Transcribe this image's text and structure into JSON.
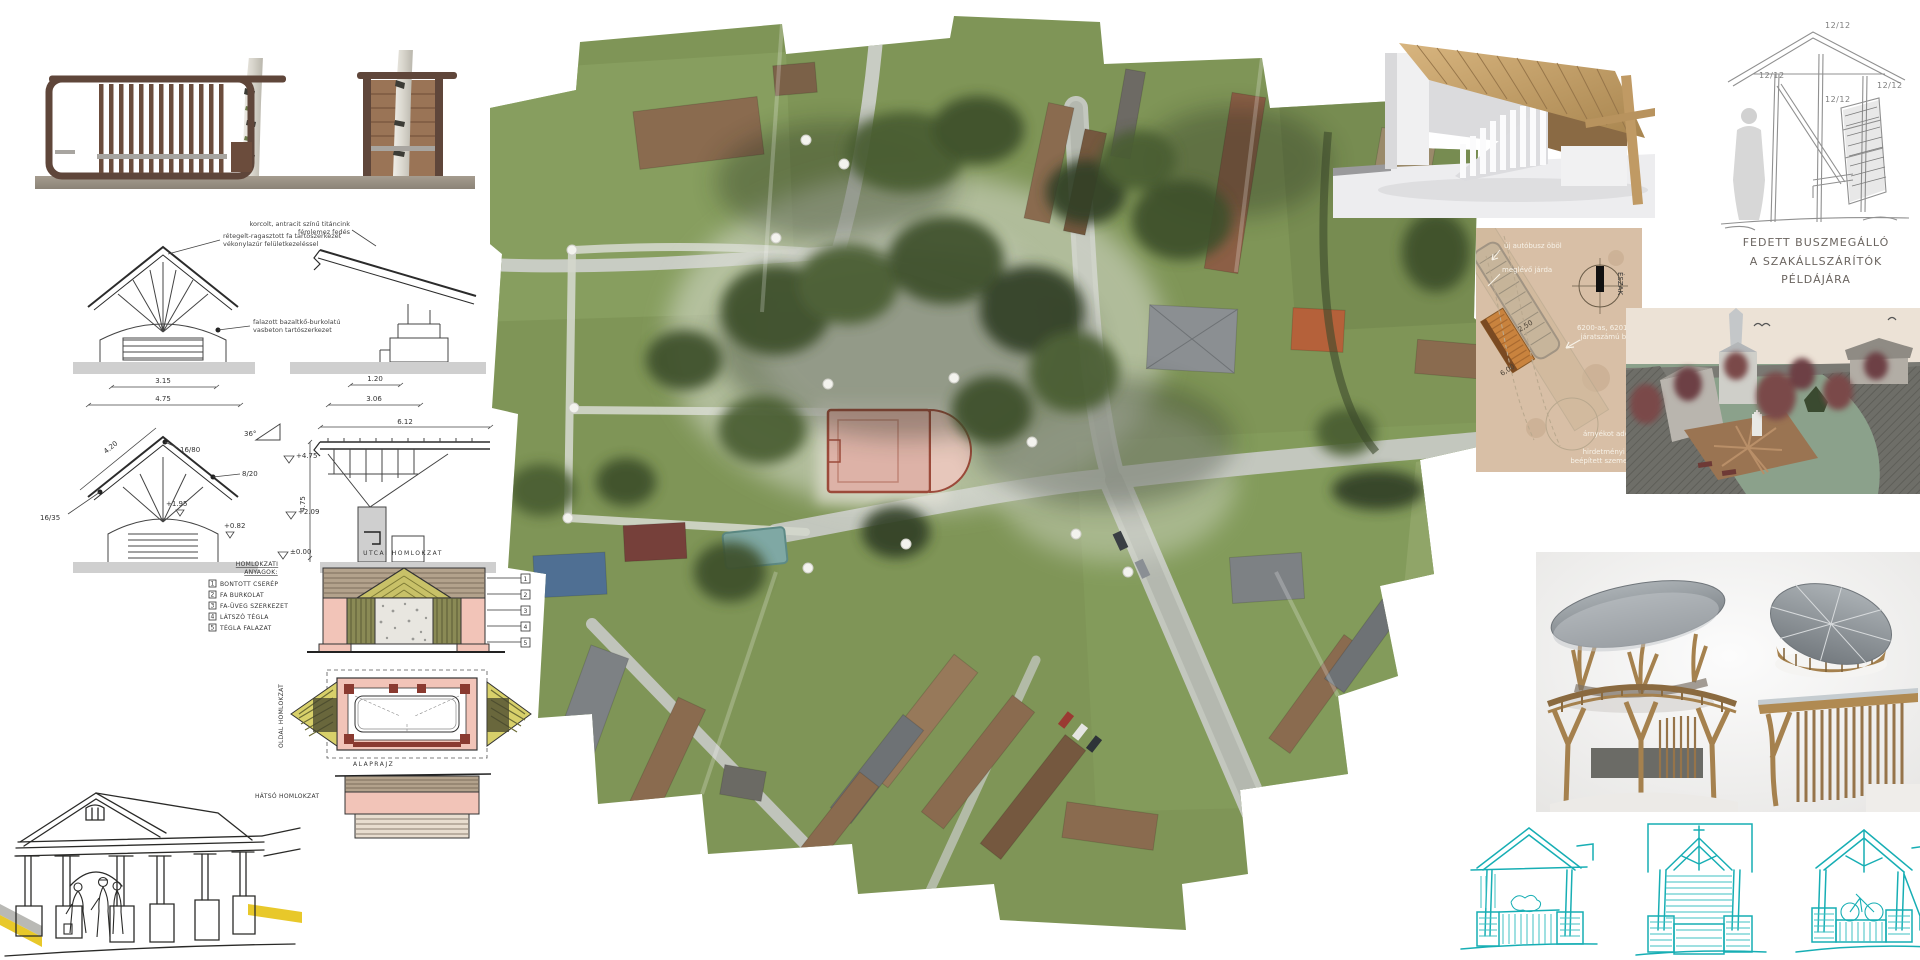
{
  "colors": {
    "shelter_wood": "#5f463a",
    "accent_wood": "#b5925f",
    "teal_ink": "#17aeb4",
    "court_pink": "#dcb1a6",
    "legend_pink": "#f2c4b8",
    "sketch_yellow": "#e8c82a",
    "siteplan_tan": "#d8bfa6"
  },
  "tech": {
    "ann_roof1a": "rétegelt-ragasztott fa tartószerkezet",
    "ann_roof1b": "vékonylazúr felületkezeléssel",
    "ann_roof2a": "korcolt, antracit színű titáncink",
    "ann_roof2b": "fémlemez fedés",
    "ann_base_a": "falazott bazaltkő-burkolatú",
    "ann_base_b": "vasbeton tartószerkezet",
    "d_315": "3.15",
    "d_475": "4.75",
    "d_120": "1.20",
    "d_306": "3.06",
    "d_420": "4.20",
    "d_612": "6.12",
    "dv_475": "4.75",
    "s_1680": "16/80",
    "s_820": "8/20",
    "s_1635": "16/35",
    "angle": "36°",
    "lvl_475": "+4.75",
    "lvl_209": "+2.09",
    "lvl_195": "+1.95",
    "lvl_082": "+0.82",
    "lvl_000": "±0.00"
  },
  "colored": {
    "title_street": "UTCAI HOMLOKZAT",
    "legend_title1": "HOMLOKZATI",
    "legend_title2": "ANYAGOK:",
    "items": [
      {
        "num": "1",
        "label": "BONTOTT CSERÉP"
      },
      {
        "num": "2",
        "label": "FA BURKOLAT"
      },
      {
        "num": "3",
        "label": "FA-ÜVEG SZERKEZET"
      },
      {
        "num": "4",
        "label": "LÁTSZÓ TÉGLA"
      },
      {
        "num": "5",
        "label": "TÉGLA FALAZAT"
      }
    ],
    "callouts": [
      "1",
      "2",
      "3",
      "4",
      "5"
    ],
    "plan_label": "ALAPRAJZ",
    "side_label": "OLDAL HOMLOKZAT",
    "rear_label": "HÁTSÓ HOMLOKZAT"
  },
  "sketch_right": {
    "d1": "12/12",
    "d2": "12/12",
    "d3": "12/12",
    "d4": "12/12",
    "cap1": "FEDETT BUSZMEGÁLLÓ",
    "cap2": "A SZAKÁLLSZÁRÍTÓK",
    "cap3": "PÉLDÁJÁRA"
  },
  "siteplan": {
    "label_bay": "új autóbusz öböl",
    "label_sidewalk": "meglévő járda",
    "label_north": "ÉSZAK",
    "label_bus1": "6200-as, 6201-es",
    "label_bus2": "járatszámú busz",
    "dim_250": "2,50",
    "dim_600": "6,00",
    "label_tree": "árnyékot adó fa",
    "label_wall1": "hirdetményi fal,",
    "label_wall2": "beépített szemetes"
  }
}
